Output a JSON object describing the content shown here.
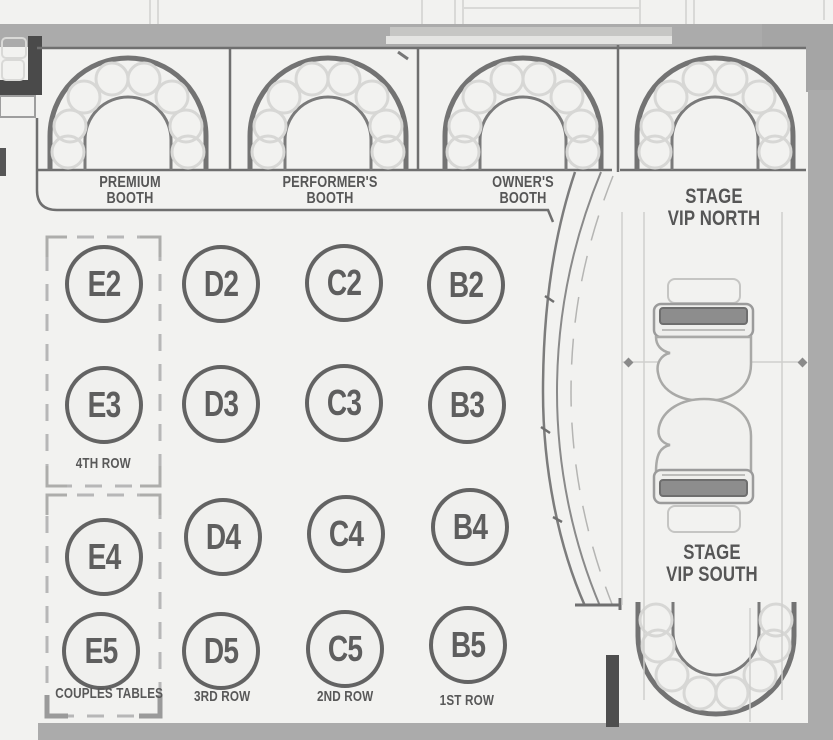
{
  "booths": [
    {
      "id": "premium-booth",
      "line1": "PREMIUM",
      "line2": "BOOTH"
    },
    {
      "id": "performers-booth",
      "line1": "PERFORMER'S",
      "line2": "BOOTH"
    },
    {
      "id": "owners-booth",
      "line1": "OWNER'S",
      "line2": "BOOTH"
    }
  ],
  "vip": [
    {
      "id": "stage-vip-north",
      "line1": "STAGE",
      "line2": "VIP NORTH"
    },
    {
      "id": "stage-vip-south",
      "line1": "STAGE",
      "line2": "VIP SOUTH"
    }
  ],
  "tables": [
    {
      "id": "E2",
      "label": "E2"
    },
    {
      "id": "D2",
      "label": "D2"
    },
    {
      "id": "C2",
      "label": "C2"
    },
    {
      "id": "B2",
      "label": "B2"
    },
    {
      "id": "E3",
      "label": "E3"
    },
    {
      "id": "D3",
      "label": "D3"
    },
    {
      "id": "C3",
      "label": "C3"
    },
    {
      "id": "B3",
      "label": "B3"
    },
    {
      "id": "E4",
      "label": "E4"
    },
    {
      "id": "D4",
      "label": "D4"
    },
    {
      "id": "C4",
      "label": "C4"
    },
    {
      "id": "B4",
      "label": "B4"
    },
    {
      "id": "E5",
      "label": "E5"
    },
    {
      "id": "D5",
      "label": "D5"
    },
    {
      "id": "C5",
      "label": "C5"
    },
    {
      "id": "B5",
      "label": "B5"
    }
  ],
  "rows": [
    {
      "id": "fourth-row",
      "label": "4TH ROW"
    },
    {
      "id": "couples-tables",
      "label": "COUPLES TABLES"
    },
    {
      "id": "third-row",
      "label": "3RD ROW"
    },
    {
      "id": "second-row",
      "label": "2ND ROW"
    },
    {
      "id": "first-row",
      "label": "1ST ROW"
    }
  ],
  "colors": {
    "background": "#f2f2f0",
    "line_dark": "#6b6b6b",
    "seat_circle": "#d7d7d5",
    "corridor_gray": "#ababab",
    "text": "#585858",
    "dashed_outline": "#b7b7b7",
    "dark_wall": "#4a4a4a"
  }
}
